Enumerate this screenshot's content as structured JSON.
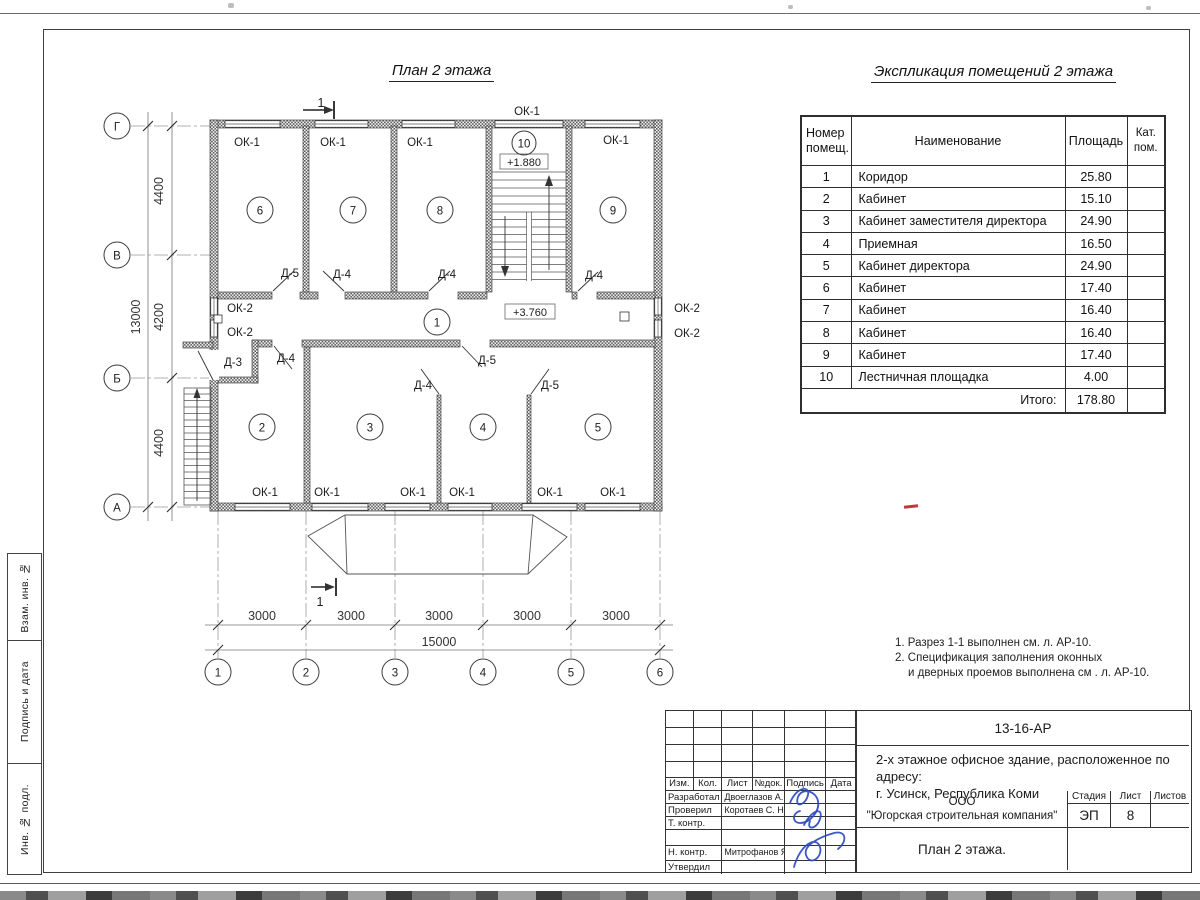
{
  "titles": {
    "plan": "План 2 этажа",
    "explication": "Экспликация помещений 2 этажа"
  },
  "explication_table": {
    "headers": {
      "number": "Номер\nпомещ.",
      "name": "Наименование",
      "area": "Площадь",
      "cat": "Кат.\nпом."
    },
    "rows": [
      {
        "n": "1",
        "name": "Коридор",
        "area": "25.80"
      },
      {
        "n": "2",
        "name": "Кабинет",
        "area": "15.10"
      },
      {
        "n": "3",
        "name": "Кабинет заместителя директора",
        "area": "24.90"
      },
      {
        "n": "4",
        "name": "Приемная",
        "area": "16.50"
      },
      {
        "n": "5",
        "name": "Кабинет директора",
        "area": "24.90"
      },
      {
        "n": "6",
        "name": "Кабинет",
        "area": "17.40"
      },
      {
        "n": "7",
        "name": "Кабинет",
        "area": "16.40"
      },
      {
        "n": "8",
        "name": "Кабинет",
        "area": "16.40"
      },
      {
        "n": "9",
        "name": "Кабинет",
        "area": "17.40"
      },
      {
        "n": "10",
        "name": "Лестничная площадка",
        "area": "4.00"
      }
    ],
    "total_label": "Итого:",
    "total_value": "178.80"
  },
  "notes": [
    "1. Разрез 1-1 выполнен см. л. АР-10.",
    "2. Спецификация заполнения оконных",
    "и дверных проемов выполнена см . л. АР-10."
  ],
  "plan": {
    "labels": [
      {
        "t": "ОК-1",
        "x": 527,
        "y": 115
      },
      {
        "t": "ОК-1",
        "x": 247,
        "y": 146
      },
      {
        "t": "ОК-1",
        "x": 333,
        "y": 146
      },
      {
        "t": "ОК-1",
        "x": 420,
        "y": 146
      },
      {
        "t": "ОК-1",
        "x": 616,
        "y": 144
      },
      {
        "t": "ОК-2",
        "x": 240,
        "y": 312
      },
      {
        "t": "ОК-2",
        "x": 240,
        "y": 336
      },
      {
        "t": "ОК-2",
        "x": 687,
        "y": 312
      },
      {
        "t": "ОК-2",
        "x": 687,
        "y": 337
      },
      {
        "t": "ОК-1",
        "x": 265,
        "y": 496
      },
      {
        "t": "ОК-1",
        "x": 327,
        "y": 496
      },
      {
        "t": "ОК-1",
        "x": 413,
        "y": 496
      },
      {
        "t": "ОК-1",
        "x": 462,
        "y": 496
      },
      {
        "t": "ОК-1",
        "x": 550,
        "y": 496
      },
      {
        "t": "ОК-1",
        "x": 613,
        "y": 496
      },
      {
        "t": "Д-5",
        "x": 290,
        "y": 277
      },
      {
        "t": "Д-4",
        "x": 342,
        "y": 278
      },
      {
        "t": "Д-4",
        "x": 447,
        "y": 278
      },
      {
        "t": "Д-4",
        "x": 594,
        "y": 279
      },
      {
        "t": "Д-3",
        "x": 233,
        "y": 366
      },
      {
        "t": "Д-4",
        "x": 286,
        "y": 362
      },
      {
        "t": "Д-4",
        "x": 423,
        "y": 389
      },
      {
        "t": "Д-5",
        "x": 487,
        "y": 364
      },
      {
        "t": "Д-5",
        "x": 550,
        "y": 389
      },
      {
        "t": "+1.880",
        "x": 524,
        "y": 166,
        "c": "elev"
      },
      {
        "t": "+3.760",
        "x": 530,
        "y": 316,
        "c": "elev"
      },
      {
        "t": "1",
        "x": 321,
        "y": 107,
        "c": "sec"
      },
      {
        "t": "1",
        "x": 320,
        "y": 606,
        "c": "sec"
      },
      {
        "t": "3000",
        "x": 262,
        "y": 620,
        "c": "dim"
      },
      {
        "t": "3000",
        "x": 351,
        "y": 620,
        "c": "dim"
      },
      {
        "t": "3000",
        "x": 439,
        "y": 620,
        "c": "dim"
      },
      {
        "t": "3000",
        "x": 527,
        "y": 620,
        "c": "dim"
      },
      {
        "t": "3000",
        "x": 616,
        "y": 620,
        "c": "dim"
      },
      {
        "t": "15000",
        "x": 439,
        "y": 646,
        "c": "dim"
      },
      {
        "t": "4400",
        "x": 163,
        "y": 191,
        "r": -90,
        "c": "dim"
      },
      {
        "t": "4200",
        "x": 163,
        "y": 317,
        "r": -90,
        "c": "dim"
      },
      {
        "t": "4400",
        "x": 163,
        "y": 443,
        "r": -90,
        "c": "dim"
      },
      {
        "t": "13000",
        "x": 140,
        "y": 317,
        "r": -90,
        "c": "dim"
      }
    ],
    "bubbles": [
      {
        "t": "Г",
        "x": 117,
        "y": 126,
        "c": "axis"
      },
      {
        "t": "В",
        "x": 117,
        "y": 255,
        "c": "axis"
      },
      {
        "t": "Б",
        "x": 117,
        "y": 378,
        "c": "axis"
      },
      {
        "t": "А",
        "x": 117,
        "y": 507,
        "c": "axis"
      },
      {
        "t": "1",
        "x": 218,
        "y": 672,
        "c": "axis"
      },
      {
        "t": "2",
        "x": 306,
        "y": 672,
        "c": "axis"
      },
      {
        "t": "3",
        "x": 395,
        "y": 672,
        "c": "axis"
      },
      {
        "t": "4",
        "x": 483,
        "y": 672,
        "c": "axis"
      },
      {
        "t": "5",
        "x": 571,
        "y": 672,
        "c": "axis"
      },
      {
        "t": "6",
        "x": 660,
        "y": 672,
        "c": "axis"
      },
      {
        "t": "6",
        "x": 260,
        "y": 210,
        "c": "room"
      },
      {
        "t": "7",
        "x": 353,
        "y": 210,
        "c": "room"
      },
      {
        "t": "8",
        "x": 440,
        "y": 210,
        "c": "room"
      },
      {
        "t": "10",
        "x": 524,
        "y": 143,
        "c": "room"
      },
      {
        "t": "9",
        "x": 613,
        "y": 210,
        "c": "room"
      },
      {
        "t": "1",
        "x": 437,
        "y": 322,
        "c": "room"
      },
      {
        "t": "2",
        "x": 262,
        "y": 427,
        "c": "room"
      },
      {
        "t": "3",
        "x": 370,
        "y": 427,
        "c": "room"
      },
      {
        "t": "4",
        "x": 483,
        "y": 427,
        "c": "room"
      },
      {
        "t": "5",
        "x": 598,
        "y": 427,
        "c": "room"
      }
    ]
  },
  "title_block": {
    "doc_number": "13-16-АР",
    "project_line1": "2-х этажное офисное здание, расположенное по адресу:",
    "project_line2": "г. Усинск, Республика Коми",
    "org_line1": "ООО",
    "org_line2": "\"Югорская строительная компания\"",
    "sheet_title": "План 2 этажа.",
    "stage_label": "Стадия",
    "sheet_label": "Лист",
    "sheets_label": "Листов",
    "stage": "ЭП",
    "sheet": "8",
    "sheets": "",
    "cols": [
      "Изм.",
      "Кол.",
      "Лист",
      "№док.",
      "Подпись",
      "Дата"
    ],
    "rows": [
      {
        "role": "Разработал",
        "name": "Двоеглазов А. В."
      },
      {
        "role": "Проверил",
        "name": "Коротаев С. Н."
      },
      {
        "role": "Т. контр.",
        "name": ""
      },
      {
        "role": "",
        "name": ""
      },
      {
        "role": "Н. контр.",
        "name": "Митрофанов Я. А."
      },
      {
        "role": "Утвердил",
        "name": ""
      }
    ]
  },
  "side_stamp": [
    "Взам. инв. №",
    "Подпись и дата",
    "Инв. № подл."
  ]
}
